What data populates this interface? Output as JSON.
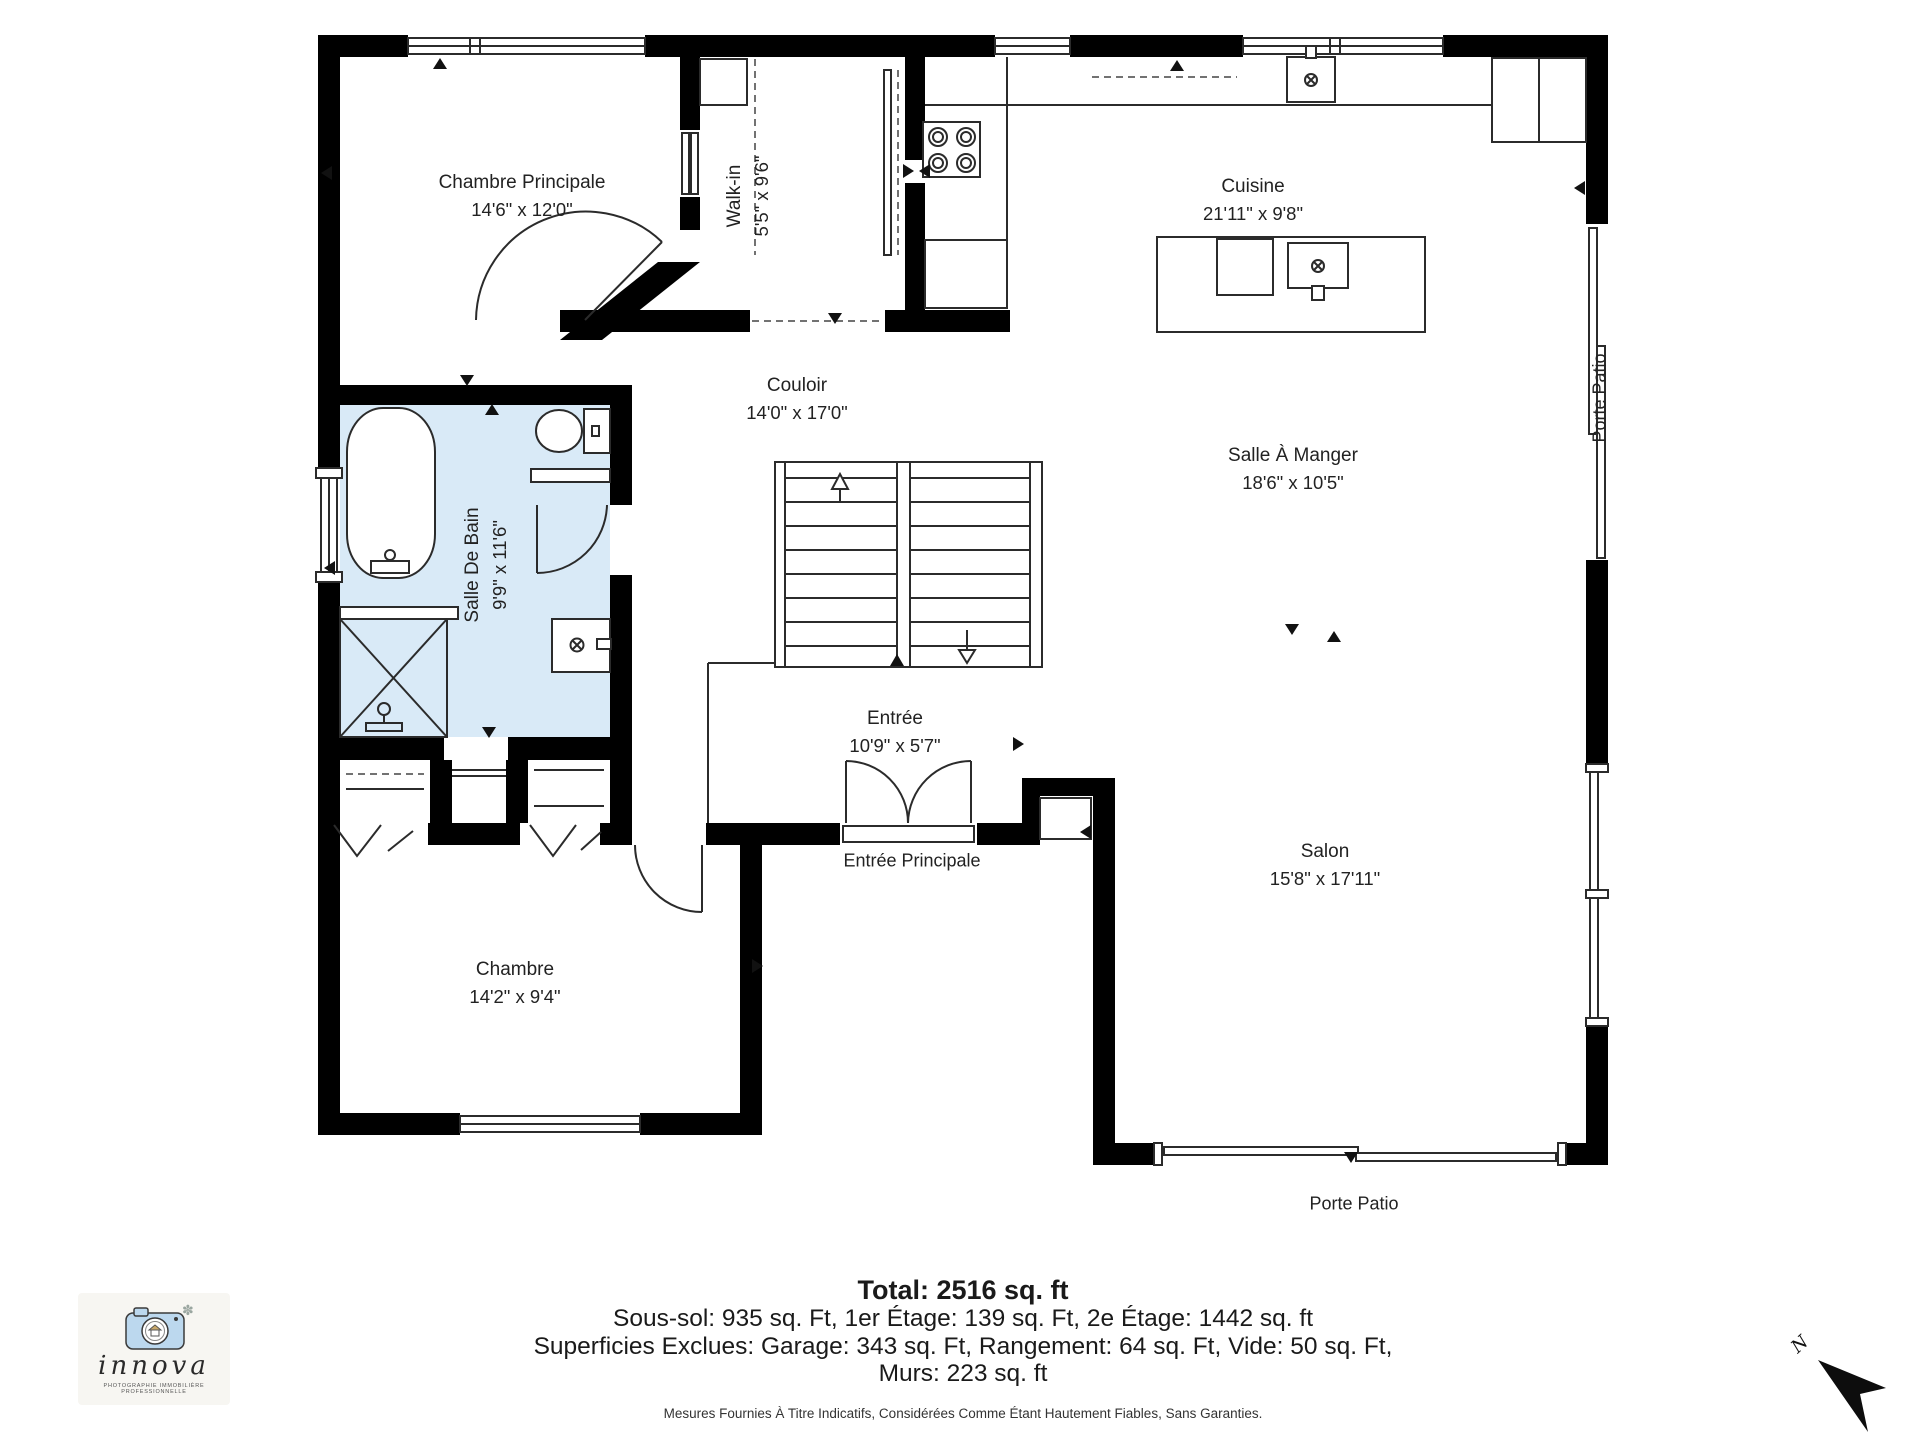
{
  "rooms": [
    {
      "id": "chambre-principale",
      "name": "Chambre Principale",
      "dims": "14'6\" x 12'0\""
    },
    {
      "id": "walk-in",
      "name": "Walk-in",
      "dims": "5'5\" x 9'6\""
    },
    {
      "id": "cuisine",
      "name": "Cuisine",
      "dims": "21'11\" x 9'8\""
    },
    {
      "id": "couloir",
      "name": "Couloir",
      "dims": "14'0\" x 17'0\""
    },
    {
      "id": "salle-a-manger",
      "name": "Salle À Manger",
      "dims": "18'6\" x 10'5\""
    },
    {
      "id": "salle-de-bain",
      "name": "Salle De Bain",
      "dims": "9'9\" x 11'6\""
    },
    {
      "id": "entree",
      "name": "Entrée",
      "dims": "10'9\" x 5'7\""
    },
    {
      "id": "chambre",
      "name": "Chambre",
      "dims": "14'2\" x 9'4\""
    },
    {
      "id": "salon",
      "name": "Salon",
      "dims": "15'8\" x 17'11\""
    }
  ],
  "doors": {
    "entree_principale": "Entrée Principale",
    "porte_patio_right": "Porte Patio",
    "porte_patio_bottom": "Porte Patio"
  },
  "totals": {
    "total": "Total: 2516 sq. ft",
    "floors": "Sous-sol: 935 sq. Ft, 1er Étage: 139 sq. Ft, 2e Étage: 1442 sq. ft",
    "exclusions": "Superficies Exclues: Garage: 343 sq. Ft, Rangement: 64 sq. Ft, Vide: 50 sq. Ft,",
    "walls": "Murs: 223 sq. ft",
    "disclaimer": "Mesures Fournies À Titre Indicatifs, Considérées Comme Étant Hautement Fiables, Sans Garanties."
  },
  "branding": {
    "name": "innova",
    "tagline": "Photographie Immobilière Professionnelle"
  },
  "compass": {
    "north": "N"
  },
  "colors": {
    "wall": "#000000",
    "bathroom_fill": "#d9eaf7",
    "line": "#2b2b2b"
  }
}
